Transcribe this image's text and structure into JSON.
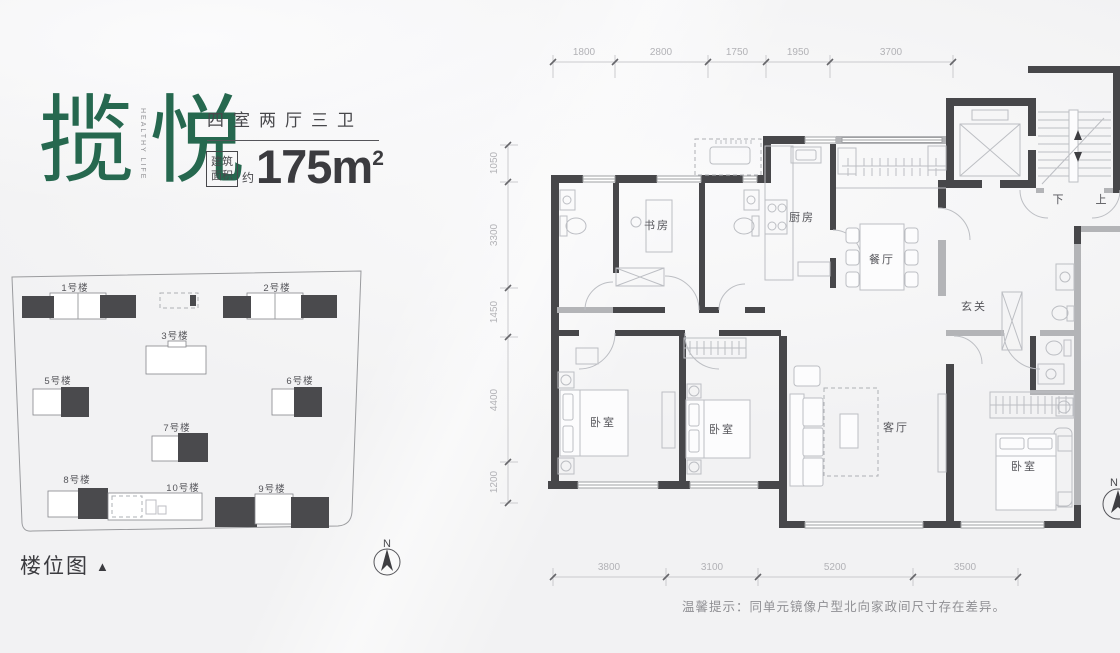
{
  "header": {
    "title_char1": "揽",
    "title_char2": "悦",
    "title_sub": "HEALTHY LIFE",
    "layout_type": "四室两厅三卫",
    "area_box_line1": "建筑",
    "area_box_line2": "面积",
    "area_prefix": "约",
    "area_value": "175m",
    "area_exponent": "2"
  },
  "site_plan": {
    "caption": "楼位图",
    "caption_marker": "▲",
    "north_label": "N",
    "buildings": [
      {
        "label": "1号楼"
      },
      {
        "label": "2号楼"
      },
      {
        "label": "3号楼"
      },
      {
        "label": "5号楼"
      },
      {
        "label": "6号楼"
      },
      {
        "label": "7号楼"
      },
      {
        "label": "8号楼"
      },
      {
        "label": "9号楼"
      },
      {
        "label": "10号楼"
      }
    ]
  },
  "floor_plan": {
    "north_label": "N",
    "rooms": {
      "study": "书房",
      "kitchen": "厨房",
      "dining": "餐厅",
      "foyer": "玄关",
      "bedroom1": "卧室",
      "bedroom2": "卧室",
      "living": "客厅",
      "master_bedroom": "卧室",
      "stair_down": "下",
      "stair_up": "上"
    },
    "dims_top": [
      "1800",
      "2800",
      "1750",
      "1950",
      "3700"
    ],
    "dims_left": [
      "1050",
      "3300",
      "1450",
      "4400",
      "1200"
    ],
    "dims_bottom": [
      "3800",
      "3100",
      "5200",
      "3500"
    ]
  },
  "note": "温馨提示：同单元镜像户型北向家政间尺寸存在差异。",
  "colors": {
    "accent_green": "#26684f",
    "wall_dark": "#47474a",
    "wall_gray": "#b3b4b7",
    "dim_text": "#b2b2b6"
  }
}
